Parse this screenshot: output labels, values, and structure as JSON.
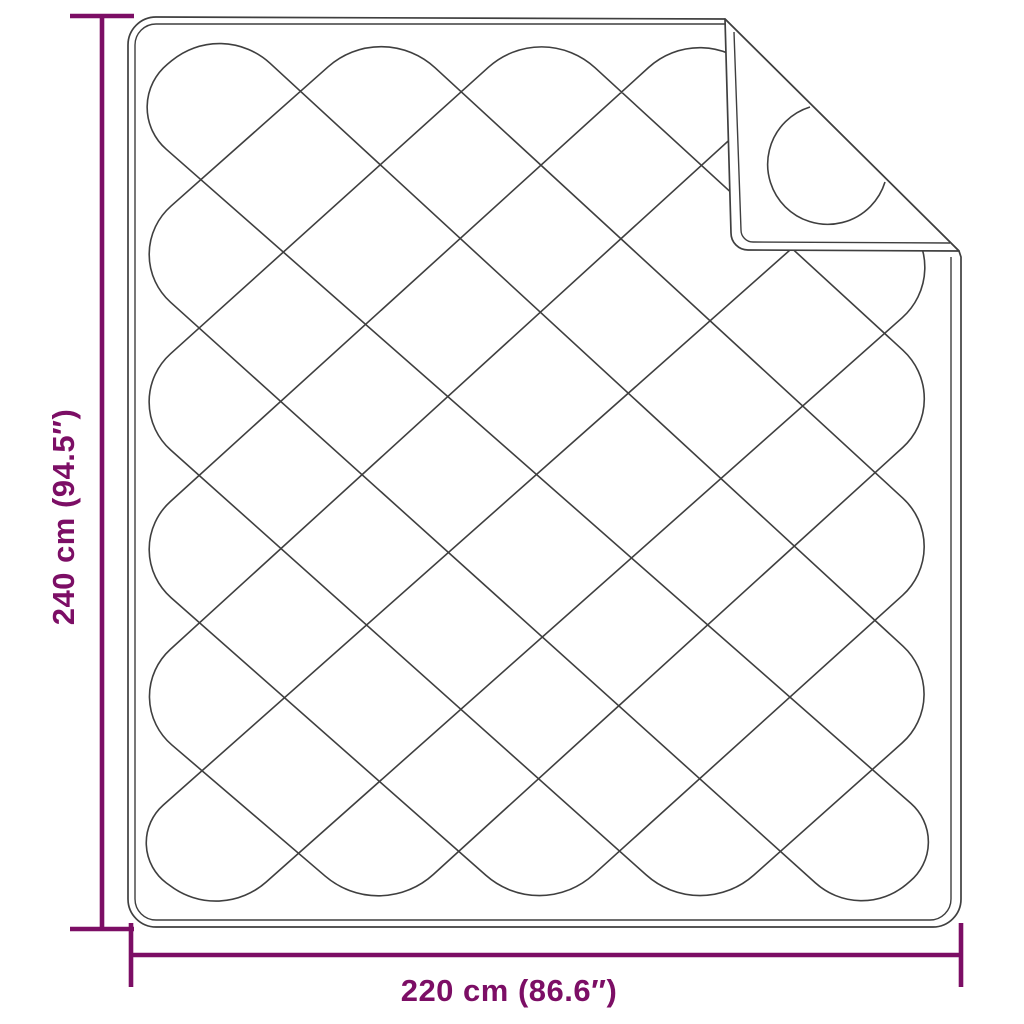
{
  "page": {
    "background": "#ffffff"
  },
  "diagram": {
    "subject": "quilted-blanket-top-view-with-folded-corner",
    "line_color": "#3f3f3f",
    "accent_color": "#7c0e65",
    "vertical_dimension": {
      "label": "240 cm (94.5″)"
    },
    "horizontal_dimension": {
      "label": "220 cm (86.6″)"
    }
  },
  "illustration": {
    "turn_radius": 72,
    "top_bump_xs": [
      222,
      382,
      542,
      702,
      862
    ],
    "top_vertex_y": 19,
    "bottom_bump_xs": [
      220,
      380,
      540,
      700,
      860
    ],
    "bottom_vertex_y": 923,
    "left_bump_ys": [
      106,
      254,
      402,
      550,
      698,
      846
    ],
    "left_vertex_x": 117,
    "right_bump_ys": [
      103,
      270,
      399,
      547,
      695,
      843
    ],
    "right_vertex_x": 956,
    "body": {
      "x0": 128,
      "y0": 17,
      "x1": 961,
      "y1": 927,
      "corner_r": 28,
      "inset": 7
    },
    "crease": {
      "x0": 725,
      "y0": 19,
      "x1": 959,
      "y1": 251
    },
    "dim_v": {
      "x": 102,
      "y0": 16,
      "y1": 929,
      "cap_half": 32
    },
    "dim_h": {
      "y": 955,
      "x0": 131,
      "x1": 961,
      "cap_half": 32
    },
    "stroke_width_outline": 1.7,
    "stroke_width_quilt": 1.6,
    "stroke_width_dim": 4.6
  }
}
